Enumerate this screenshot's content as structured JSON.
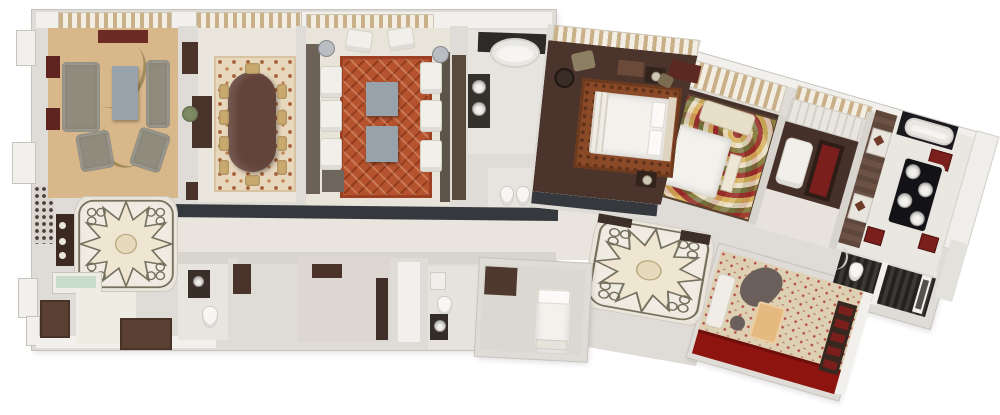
{
  "title": "3D rendered floor plan of a large multi-room hotel suite",
  "type": "architectural-floorplan-render",
  "palette": {
    "wall_base": "#dfdcd7",
    "wall_white": "#f2f0ec",
    "wall_edge": "#c6c3bd",
    "floor_cream": "#ebe6dd",
    "floor_tan": "#d8b78a",
    "wood_dark": "#4a342b",
    "wood_dark2": "#46312a",
    "charcoal": "#35383d",
    "maroon": "#7a1f1c",
    "maroon2": "#6e2b26",
    "rug_red": "#b5532e",
    "rug_dining": "#e7d7bd",
    "rug_bed1": "#8a4a28",
    "sofa_gray": "#8f8b7d",
    "chair_cream": "#f1efe9",
    "chair_tan": "#c9a96e",
    "table_bluegray": "#98a2ab",
    "wood_table": "#63443a",
    "counter_black": "#1a191d",
    "vanity_black": "#131317",
    "cab_dark": "#4a332b",
    "office_carpet": "#ddd0b3",
    "carpet_red": "#8e1410",
    "glass_green": "#c8dcc9",
    "marble": "#f0ece3",
    "star_line": "#75715f",
    "plant_green": "#7d8a62",
    "swirl_red": "#962828",
    "swirl_gold": "#d8b25c",
    "swirl_cream": "#ece2cc",
    "swirl_olive": "#6f6f39"
  },
  "rooms": [
    {
      "id": "living-room",
      "label": "Living room",
      "floor_color": "#d8b78a",
      "furniture": [
        "sofa",
        "coffee-table",
        "armchair x3",
        "console"
      ]
    },
    {
      "id": "dining-room",
      "label": "Dining room",
      "floor_color": "#ebe6dd",
      "furniture": [
        "oval dining table",
        "dining chairs x10",
        "patterned rug",
        "sideboard",
        "plant",
        "cabinets"
      ]
    },
    {
      "id": "salon",
      "label": "Salon / media lounge",
      "floor_color": "#e9e4da",
      "furniture": [
        "red trellis rug",
        "white armchairs x8",
        "square tables x2",
        "round side tables x2"
      ]
    },
    {
      "id": "bathroom-1",
      "label": "Guest bathroom",
      "floor_color": "#e7e4df",
      "furniture": [
        "oval bathtub",
        "double vanity",
        "toilet",
        "bidet"
      ]
    },
    {
      "id": "bedroom-1",
      "label": "Bedroom 1",
      "floor_color": "#4a342b",
      "furniture": [
        "double bed",
        "rust rug",
        "nightstands x2",
        "desk",
        "armchair",
        "round table",
        "bench"
      ]
    },
    {
      "id": "bedroom-2",
      "label": "Bedroom 2",
      "floor_color": "#46312a",
      "furniture": [
        "double bed",
        "swirl carpet",
        "chaise lounge",
        "bench"
      ]
    },
    {
      "id": "sitting-area",
      "label": "TV sitting area",
      "floor_color": "#46312a",
      "furniture": [
        "armchair",
        "tv-cabinet",
        "wardrobe"
      ]
    },
    {
      "id": "dressing-area",
      "label": "Dressing area",
      "floor_color": "#5d463a",
      "furniture": [
        "bench panels x2"
      ]
    },
    {
      "id": "master-bathroom",
      "label": "Master bathroom",
      "floor_color": "#eae7e1",
      "furniture": [
        "bathtub",
        "four-sink vanity island",
        "red cabinets x3"
      ]
    },
    {
      "id": "wc-shower",
      "label": "WC / shower closets",
      "floor_color": "#2b2724",
      "furniture": [
        "toilet",
        "shower tub"
      ]
    },
    {
      "id": "office",
      "label": "Study / office",
      "floor_color": "#ddd0b3",
      "furniture": [
        "white sofa",
        "desk",
        "chair blob",
        "side cabinet",
        "red runner"
      ]
    },
    {
      "id": "foyer-1",
      "label": "Foyer with star medallion",
      "floor_color": "#f0ece3",
      "furniture": [
        "console with flowers",
        "green glass shelf"
      ]
    },
    {
      "id": "foyer-2",
      "label": "Second foyer with star medallion",
      "floor_color": "#efece3",
      "furniture": []
    },
    {
      "id": "corridor",
      "label": "Corridor",
      "floor_color": "#e9e5de",
      "furniture": []
    },
    {
      "id": "powder-room",
      "label": "Powder room",
      "floor_color": "#e8e5df",
      "furniture": [
        "toilet",
        "vanity"
      ]
    },
    {
      "id": "utility-room",
      "label": "Utility room",
      "floor_color": "#dcd8d1",
      "furniture": [
        "dresser",
        "dark door"
      ]
    },
    {
      "id": "bathroom-2",
      "label": "Service bathroom",
      "floor_color": "#e6e3dd",
      "furniture": [
        "toilet",
        "round sink"
      ]
    },
    {
      "id": "staff-bedroom",
      "label": "Staff bedroom",
      "floor_color": "#dbd8d2",
      "furniture": [
        "single bed",
        "brown mat"
      ]
    },
    {
      "id": "entry",
      "label": "Entry vestibule",
      "floor_color": "#efece4",
      "furniture": []
    },
    {
      "id": "closets",
      "label": "Closets",
      "floor_color": "#5a4134",
      "furniture": []
    }
  ]
}
